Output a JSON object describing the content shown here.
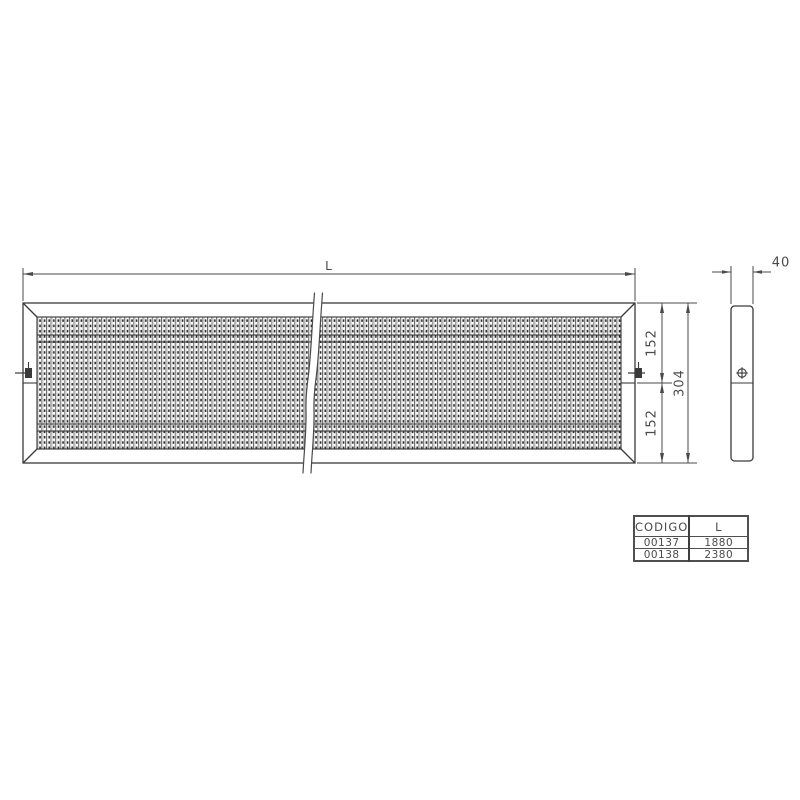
{
  "drawing": {
    "title": "perforated-grating-panel-technical-drawing",
    "dimensions": {
      "length_label": "L",
      "thickness": "40",
      "half_height_top": "152",
      "half_height_bottom": "152",
      "total_height": "304"
    },
    "table": {
      "headers": {
        "code": "CODIGO",
        "length": "L"
      },
      "rows": [
        {
          "code": "00137",
          "length": "1880"
        },
        {
          "code": "00138",
          "length": "2380"
        }
      ]
    },
    "colors": {
      "line": "#3a3a3a",
      "text": "#4a4a4a",
      "background": "#ffffff"
    }
  }
}
